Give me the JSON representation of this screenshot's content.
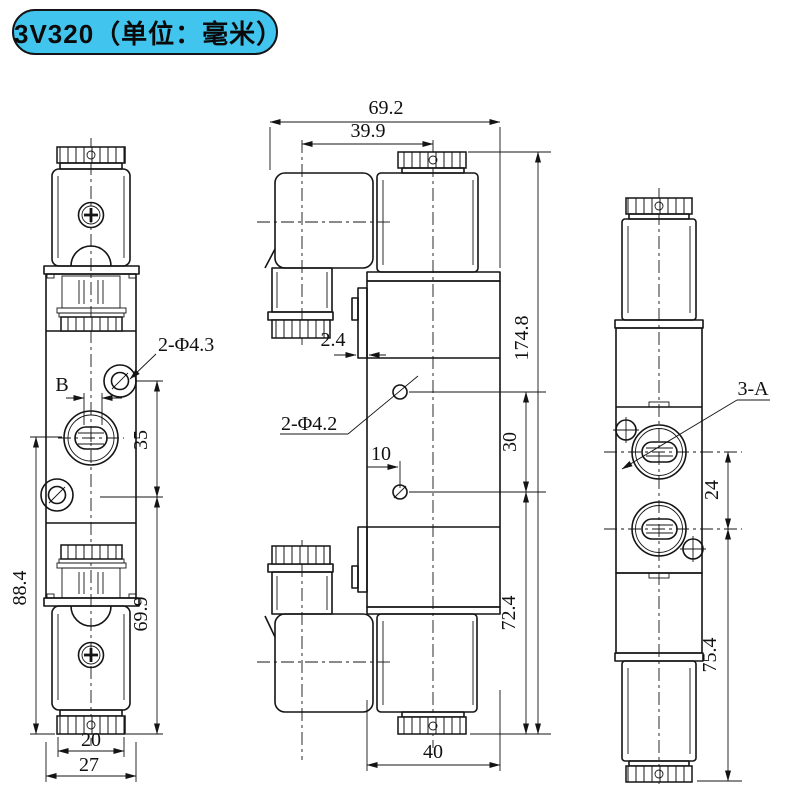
{
  "title": {
    "label": "3V320（单位：毫米）"
  },
  "colors": {
    "badge_bg": "#41c4ee",
    "line": "#141414",
    "background": "#ffffff"
  },
  "views": {
    "front": {
      "name": "front-view",
      "dims": {
        "mount_holes": "2-Φ4.3",
        "orifice": "B",
        "hole_spacing": "35",
        "overall_height": "88.4",
        "body_height": "69.9",
        "cap_width": "20",
        "body_width": "27"
      }
    },
    "side": {
      "name": "side-view",
      "dims": {
        "overall_width": "69.2",
        "connector_offset": "39.9",
        "overall_height": "174.8",
        "plate_thickness": "2.4",
        "body_holes": "2-Φ4.2",
        "hole_offset": "10",
        "hole_spacing": "30",
        "lower_height": "72.4",
        "body_width": "40"
      }
    },
    "end": {
      "name": "end-view",
      "dims": {
        "ports": "3-A",
        "port_spacing": "24",
        "lower_height": "75.4"
      }
    }
  }
}
